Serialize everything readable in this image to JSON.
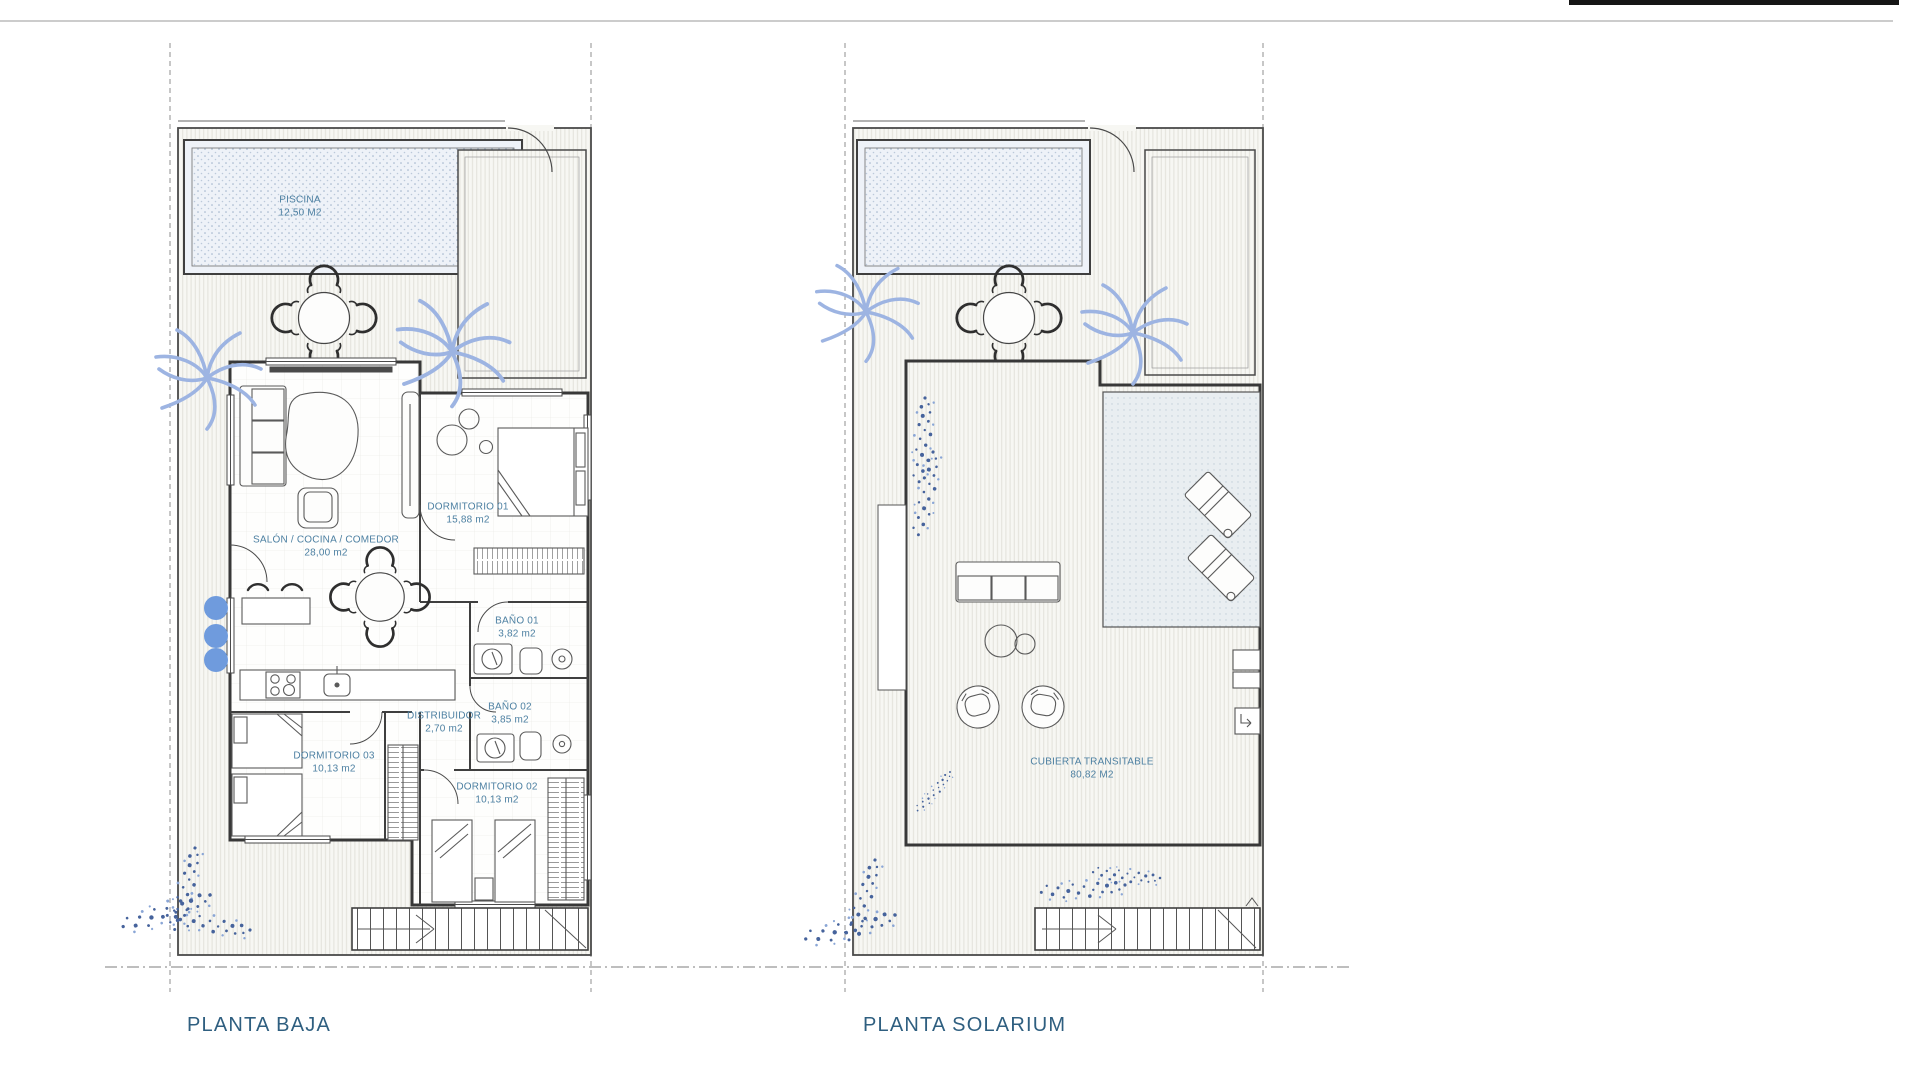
{
  "colors": {
    "label_blue": "#4d80a2",
    "title_blue": "#2f5f80",
    "palm_blue": "#9db4e2",
    "plant_speck_blue": "#46639c",
    "bush_circle_blue": "#6f9bdd",
    "line_dark": "#3f3f3f",
    "pool_fill": "#eef2f8",
    "covered_terrace_fill": "#e9eef1"
  },
  "plans": [
    {
      "title": "PLANTA BAJA",
      "rooms": [
        {
          "name": "PISCINA",
          "area": "12,50 M2"
        },
        {
          "name": "SALÓN / COCINA / COMEDOR",
          "area": "28,00 m2"
        },
        {
          "name": "DORMITORIO 01",
          "area": "15,88 m2"
        },
        {
          "name": "BAÑO 01",
          "area": "3,82 m2"
        },
        {
          "name": "BAÑO 02",
          "area": "3,85 m2"
        },
        {
          "name": "DISTRIBUIDOR",
          "area": "2,70 m2"
        },
        {
          "name": "DORMITORIO 03",
          "area": "10,13 m2"
        },
        {
          "name": "DORMITORIO 02",
          "area": "10,13 m2"
        }
      ]
    },
    {
      "title": "PLANTA SOLARIUM",
      "rooms": [
        {
          "name": "CUBIERTA TRANSITABLE",
          "area": "80,82 M2"
        }
      ]
    }
  ]
}
